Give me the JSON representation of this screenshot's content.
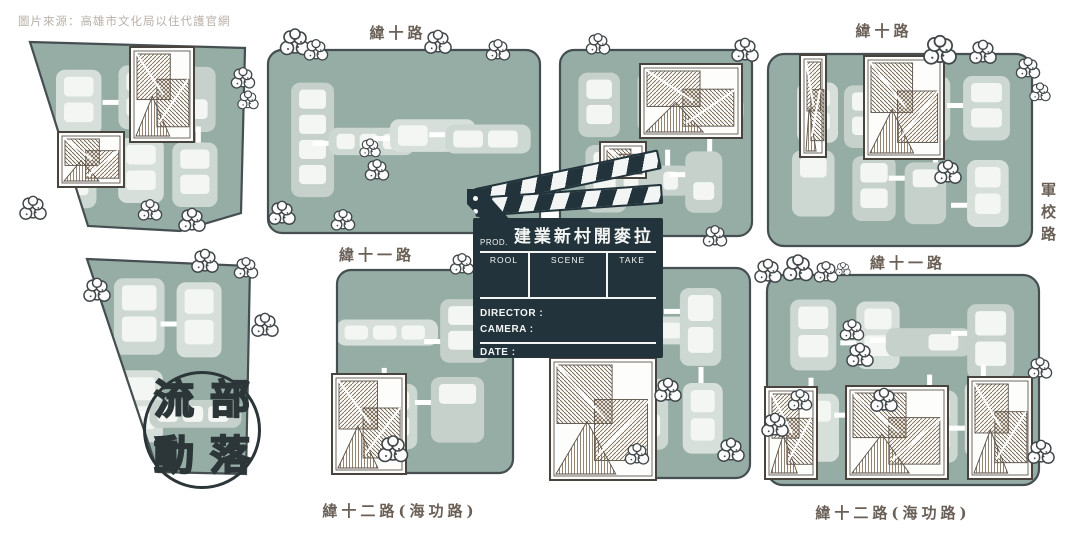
{
  "source_credit": "圖片來源：高雄市文化局以住代護官網",
  "streets": {
    "top_left": "緯十路",
    "top_right": "緯十路",
    "right_vertical": "軍校路",
    "mid_left": "緯十一路",
    "mid_right": "緯十一路",
    "bottom_left": "緯十二路(海功路)",
    "bottom_right": "緯十二路(海功路)"
  },
  "stamp": {
    "chars": [
      "流",
      "部",
      "動",
      "落"
    ]
  },
  "clapperboard": {
    "prod_label": "PROD.",
    "title": "建業新村開麥拉",
    "columns": [
      "ROOL",
      "SCENE",
      "TAKE"
    ],
    "fields": [
      "DIRECTOR :",
      "CAMERA :",
      "DATE :"
    ]
  },
  "colors": {
    "block_teal": "#96ada6",
    "building_pale": "#cdd8d2",
    "clapper_dark": "#22333b",
    "label_brown": "#6a6057",
    "credit_gray": "#b9b0a8"
  }
}
